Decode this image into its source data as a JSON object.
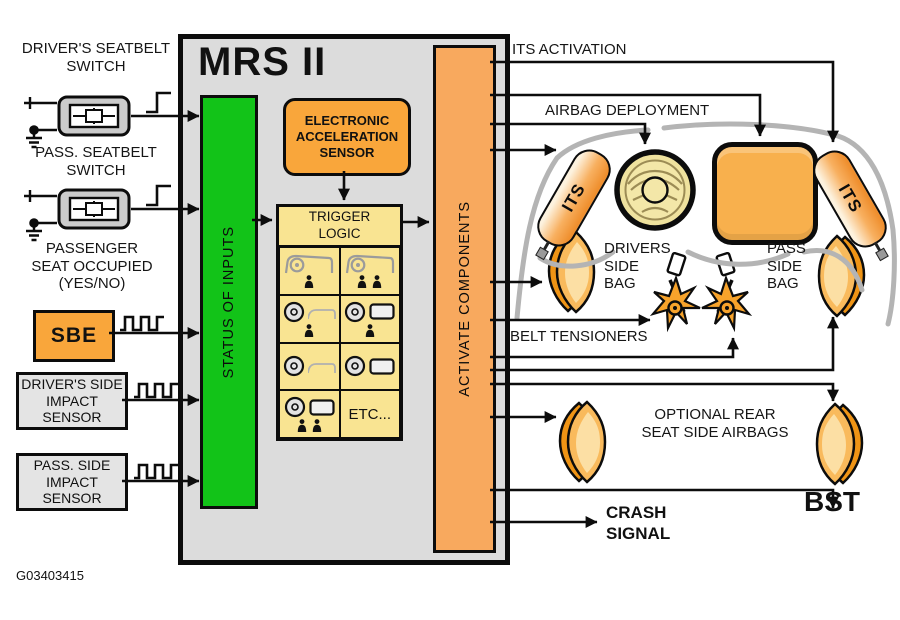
{
  "figure_id": "G03403415",
  "inputs": {
    "driver_seatbelt_label": "DRIVER'S SEATBELT\nSWITCH",
    "pass_seatbelt_label": "PASS. SEATBELT\nSWITCH",
    "seat_occupied_label": "PASSENGER\nSEAT OCCUPIED\n(YES/NO)",
    "sbe_label": "SBE",
    "driver_impact_label": "DRIVER'S SIDE\nIMPACT\nSENSOR",
    "pass_impact_label": "PASS. SIDE\nIMPACT\nSENSOR",
    "signal_types": {
      "seatbelt_switches": "step",
      "sbe": "pulse-train",
      "impact_sensors": "pulse-train"
    }
  },
  "controller": {
    "title": "MRS II",
    "status_bar": "STATUS OF INPUTS",
    "acceleration_sensor": "ELECTRONIC\nACCELERATION\nSENSOR",
    "trigger_logic_title": "TRIGGER\nLOGIC",
    "trigger_logic_etc": "ETC...",
    "activate_bar": "ACTIVATE COMPONENTS"
  },
  "outputs": {
    "its_activation": "ITS ACTIVATION",
    "airbag_deployment": "AIRBAG DEPLOYMENT",
    "its_label": "ITS",
    "drivers_side_bag": "DRIVERS\nSIDE\nBAG",
    "pass_side_bag": "PASS\nSIDE\nBAG",
    "belt_tensioners": "BELT TENSIONERS",
    "optional_rear": "OPTIONAL REAR\nSEAT SIDE AIRBAGS",
    "crash_signal": "CRASH\nSIGNAL",
    "bst": "BST"
  },
  "colors": {
    "status_green": "#12c318",
    "activate_orange": "#f8a95e",
    "sensor_orange": "#f9a63b",
    "trigger_yellow": "#f9e492",
    "panel_gray": "#dcdcdc",
    "bag_orange": "#f8b04d",
    "dashboard_gray": "#b4b4b4"
  }
}
